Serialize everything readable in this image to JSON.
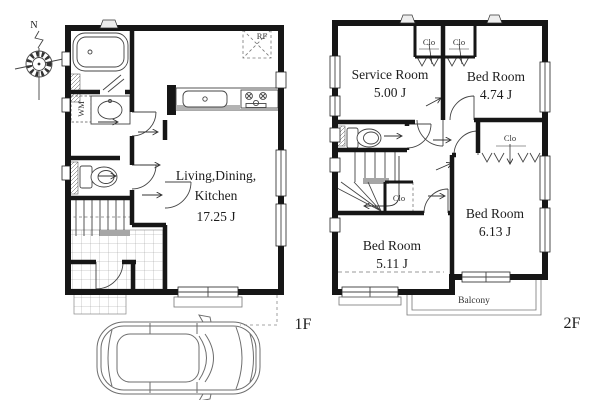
{
  "compass": {
    "north_label": "N"
  },
  "floor1": {
    "floor_label": "1F",
    "rooms": {
      "ldk": {
        "name_line1": "Living,Dining,",
        "name_line2": "Kitchen",
        "size": "17.25 J"
      }
    },
    "labels": {
      "refrigerator": "RF",
      "washing_machine": "WM"
    }
  },
  "floor2": {
    "floor_label": "2F",
    "rooms": {
      "service_room": {
        "name": "Service Room",
        "size": "5.00 J"
      },
      "bed_room_1": {
        "name": "Bed Room",
        "size": "4.74 J"
      },
      "bed_room_2": {
        "name": "Bed Room",
        "size": "6.13 J"
      },
      "bed_room_3": {
        "name": "Bed Room",
        "size": "5.11 J"
      },
      "balcony": {
        "name": "Balcony"
      }
    },
    "closet_labels": [
      "Clo",
      "Clo",
      "Clo",
      "Clo"
    ]
  },
  "colors": {
    "wall": "#161616",
    "thin_line": "#444444",
    "light_gray": "#aaaaaa",
    "background": "#ffffff"
  }
}
